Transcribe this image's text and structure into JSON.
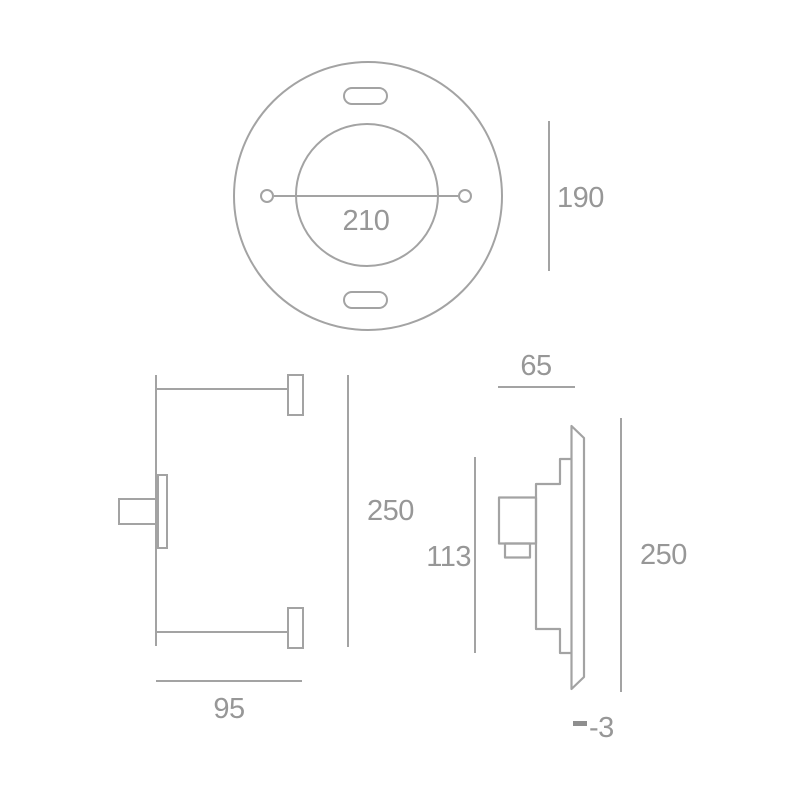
{
  "colors": {
    "background": "#ffffff",
    "line": "#a3a3a3",
    "text": "#979797",
    "tick": "#8f8f8f"
  },
  "views": {
    "top": {
      "dim_hole_distance": "210",
      "dim_height": "190"
    },
    "front": {
      "dim_height": "250",
      "dim_depth": "95"
    },
    "side": {
      "dim_width": "65",
      "dim_recess_depth": "113",
      "dim_height": "250",
      "dim_protrusion": "-3"
    }
  }
}
